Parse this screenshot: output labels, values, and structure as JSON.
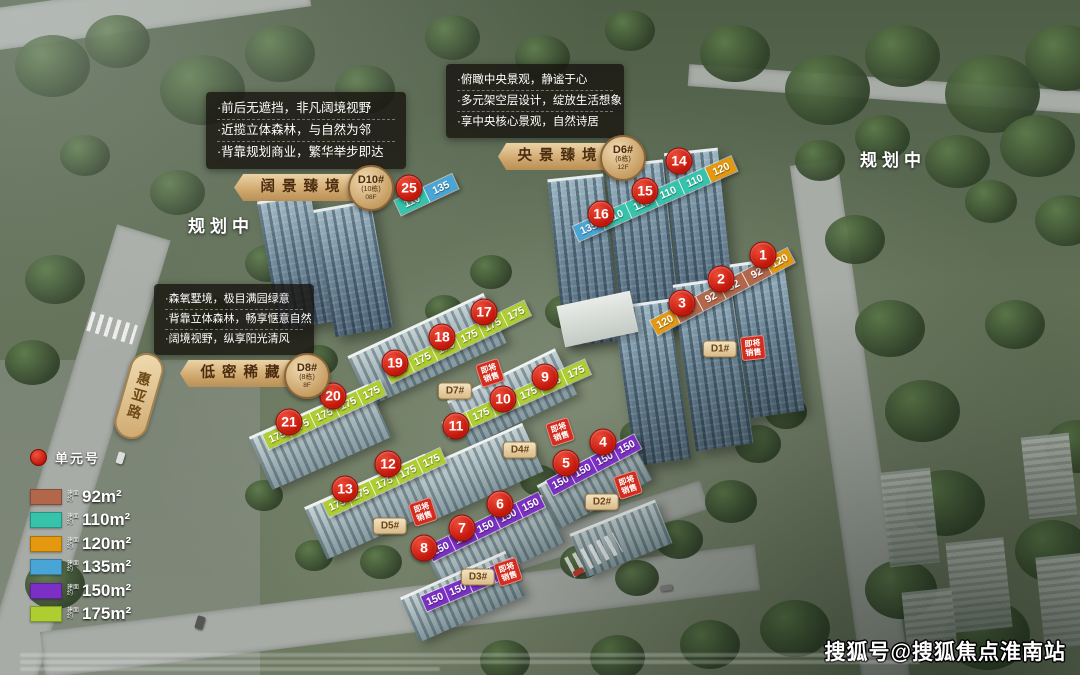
{
  "watermark": "搜狐号@搜狐焦点淮南站",
  "planning_labels": {
    "left": "规划中",
    "right": "规划中"
  },
  "road_label": "惠亚路",
  "legend": {
    "unit_marker_label": "单元号",
    "prefix_lines": [
      "建面",
      "约"
    ],
    "items": [
      {
        "key": "92",
        "area": "92m²"
      },
      {
        "key": "110",
        "area": "110m²"
      },
      {
        "key": "120",
        "area": "120m²"
      },
      {
        "key": "135",
        "area": "135m²"
      },
      {
        "key": "150",
        "area": "150m²"
      },
      {
        "key": "175",
        "area": "175m²"
      }
    ]
  },
  "area_colors": {
    "92": "#b2674a",
    "110": "#36c3ab",
    "120": "#e3980f",
    "135": "#49a5d6",
    "150": "#7b2fc4",
    "175": "#aecd31"
  },
  "info_cards": [
    {
      "bullets": [
        "·前后无遮挡，非凡阔境视野",
        "·近揽立体森林，与自然为邻",
        "·背靠规划商业，繁华举步即达"
      ],
      "banner": "阔景臻境",
      "badge_code": "D10#",
      "badge_sub": "(10栋)",
      "badge_floor": "08F"
    },
    {
      "bullets": [
        "·俯瞰中央景观，静谧于心",
        "·多元架空层设计，绽放生活想象",
        "·享中央核心景观，自然诗居"
      ],
      "banner": "央景臻境",
      "badge_code": "D6#",
      "badge_sub": "(6栋)",
      "badge_floor": "12F"
    },
    {
      "bullets": [
        "·森氧墅境，极目满园绿意",
        "·背靠立体森林，畅享惬意自然",
        "·阔境视野，纵享阳光清风"
      ],
      "banner": "低密稀藏",
      "badge_code": "D8#",
      "badge_sub": "(8栋)",
      "badge_floor": "8F"
    }
  ],
  "sale_tag_lines": [
    "即将",
    "销售"
  ],
  "unit_badges": [
    {
      "num": "1",
      "x": 763,
      "y": 255
    },
    {
      "num": "2",
      "x": 721,
      "y": 279
    },
    {
      "num": "3",
      "x": 682,
      "y": 303
    },
    {
      "num": "4",
      "x": 603,
      "y": 442
    },
    {
      "num": "5",
      "x": 566,
      "y": 463
    },
    {
      "num": "6",
      "x": 500,
      "y": 504
    },
    {
      "num": "7",
      "x": 462,
      "y": 528
    },
    {
      "num": "8",
      "x": 424,
      "y": 548
    },
    {
      "num": "9",
      "x": 545,
      "y": 377
    },
    {
      "num": "10",
      "x": 503,
      "y": 399
    },
    {
      "num": "11",
      "x": 456,
      "y": 426
    },
    {
      "num": "12",
      "x": 388,
      "y": 464
    },
    {
      "num": "13",
      "x": 345,
      "y": 489
    },
    {
      "num": "14",
      "x": 679,
      "y": 161
    },
    {
      "num": "15",
      "x": 645,
      "y": 191
    },
    {
      "num": "16",
      "x": 601,
      "y": 214
    },
    {
      "num": "17",
      "x": 484,
      "y": 312
    },
    {
      "num": "18",
      "x": 442,
      "y": 337
    },
    {
      "num": "19",
      "x": 395,
      "y": 363
    },
    {
      "num": "20",
      "x": 333,
      "y": 396
    },
    {
      "num": "21",
      "x": 289,
      "y": 422
    },
    {
      "num": "25",
      "x": 409,
      "y": 188
    }
  ],
  "strips": [
    {
      "x": 398,
      "y": 208,
      "rot": -25,
      "w": 31,
      "tiles": [
        "110",
        "135"
      ]
    },
    {
      "x": 576,
      "y": 234,
      "rot": -24,
      "w": 28,
      "tiles": [
        "135",
        "110",
        "110",
        "110",
        "110",
        "120"
      ]
    },
    {
      "x": 654,
      "y": 328,
      "rot": -28,
      "w": 25,
      "tiles": [
        "120",
        "92",
        "92",
        "92",
        "92",
        "120"
      ]
    },
    {
      "x": 388,
      "y": 376,
      "rot": -26,
      "w": 25,
      "tiles": [
        "175",
        "175",
        "175",
        "175",
        "175",
        "175"
      ]
    },
    {
      "x": 446,
      "y": 430,
      "rot": -24,
      "w": 25,
      "tiles": [
        "175",
        "175",
        "175",
        "175",
        "175",
        "175"
      ]
    },
    {
      "x": 266,
      "y": 442,
      "rot": -25,
      "w": 25,
      "tiles": [
        "175",
        "175",
        "175",
        "175",
        "175"
      ]
    },
    {
      "x": 326,
      "y": 510,
      "rot": -25,
      "w": 25,
      "tiles": [
        "175",
        "175",
        "175",
        "175",
        "175"
      ]
    },
    {
      "x": 550,
      "y": 488,
      "rot": -28,
      "w": 24,
      "tiles": [
        "150",
        "150",
        "150",
        "150"
      ]
    },
    {
      "x": 430,
      "y": 554,
      "rot": -26,
      "w": 24,
      "tiles": [
        "150",
        "150",
        "150",
        "150",
        "150"
      ]
    },
    {
      "x": 424,
      "y": 604,
      "rot": -23,
      "w": 24,
      "tiles": [
        "150",
        "150",
        "150",
        "150"
      ]
    }
  ],
  "building_pills": [
    {
      "label": "D1#",
      "x": 720,
      "y": 349
    },
    {
      "label": "D2#",
      "x": 602,
      "y": 502
    },
    {
      "label": "D3#",
      "x": 478,
      "y": 577
    },
    {
      "label": "D4#",
      "x": 520,
      "y": 450
    },
    {
      "label": "D5#",
      "x": 390,
      "y": 526
    },
    {
      "label": "D7#",
      "x": 455,
      "y": 391
    }
  ],
  "sale_tags": [
    {
      "x": 753,
      "y": 348,
      "rot": -6
    },
    {
      "x": 628,
      "y": 485,
      "rot": -18
    },
    {
      "x": 560,
      "y": 432,
      "rot": -18
    },
    {
      "x": 490,
      "y": 373,
      "rot": -18
    },
    {
      "x": 423,
      "y": 512,
      "rot": -18
    },
    {
      "x": 508,
      "y": 572,
      "rot": -18
    }
  ]
}
